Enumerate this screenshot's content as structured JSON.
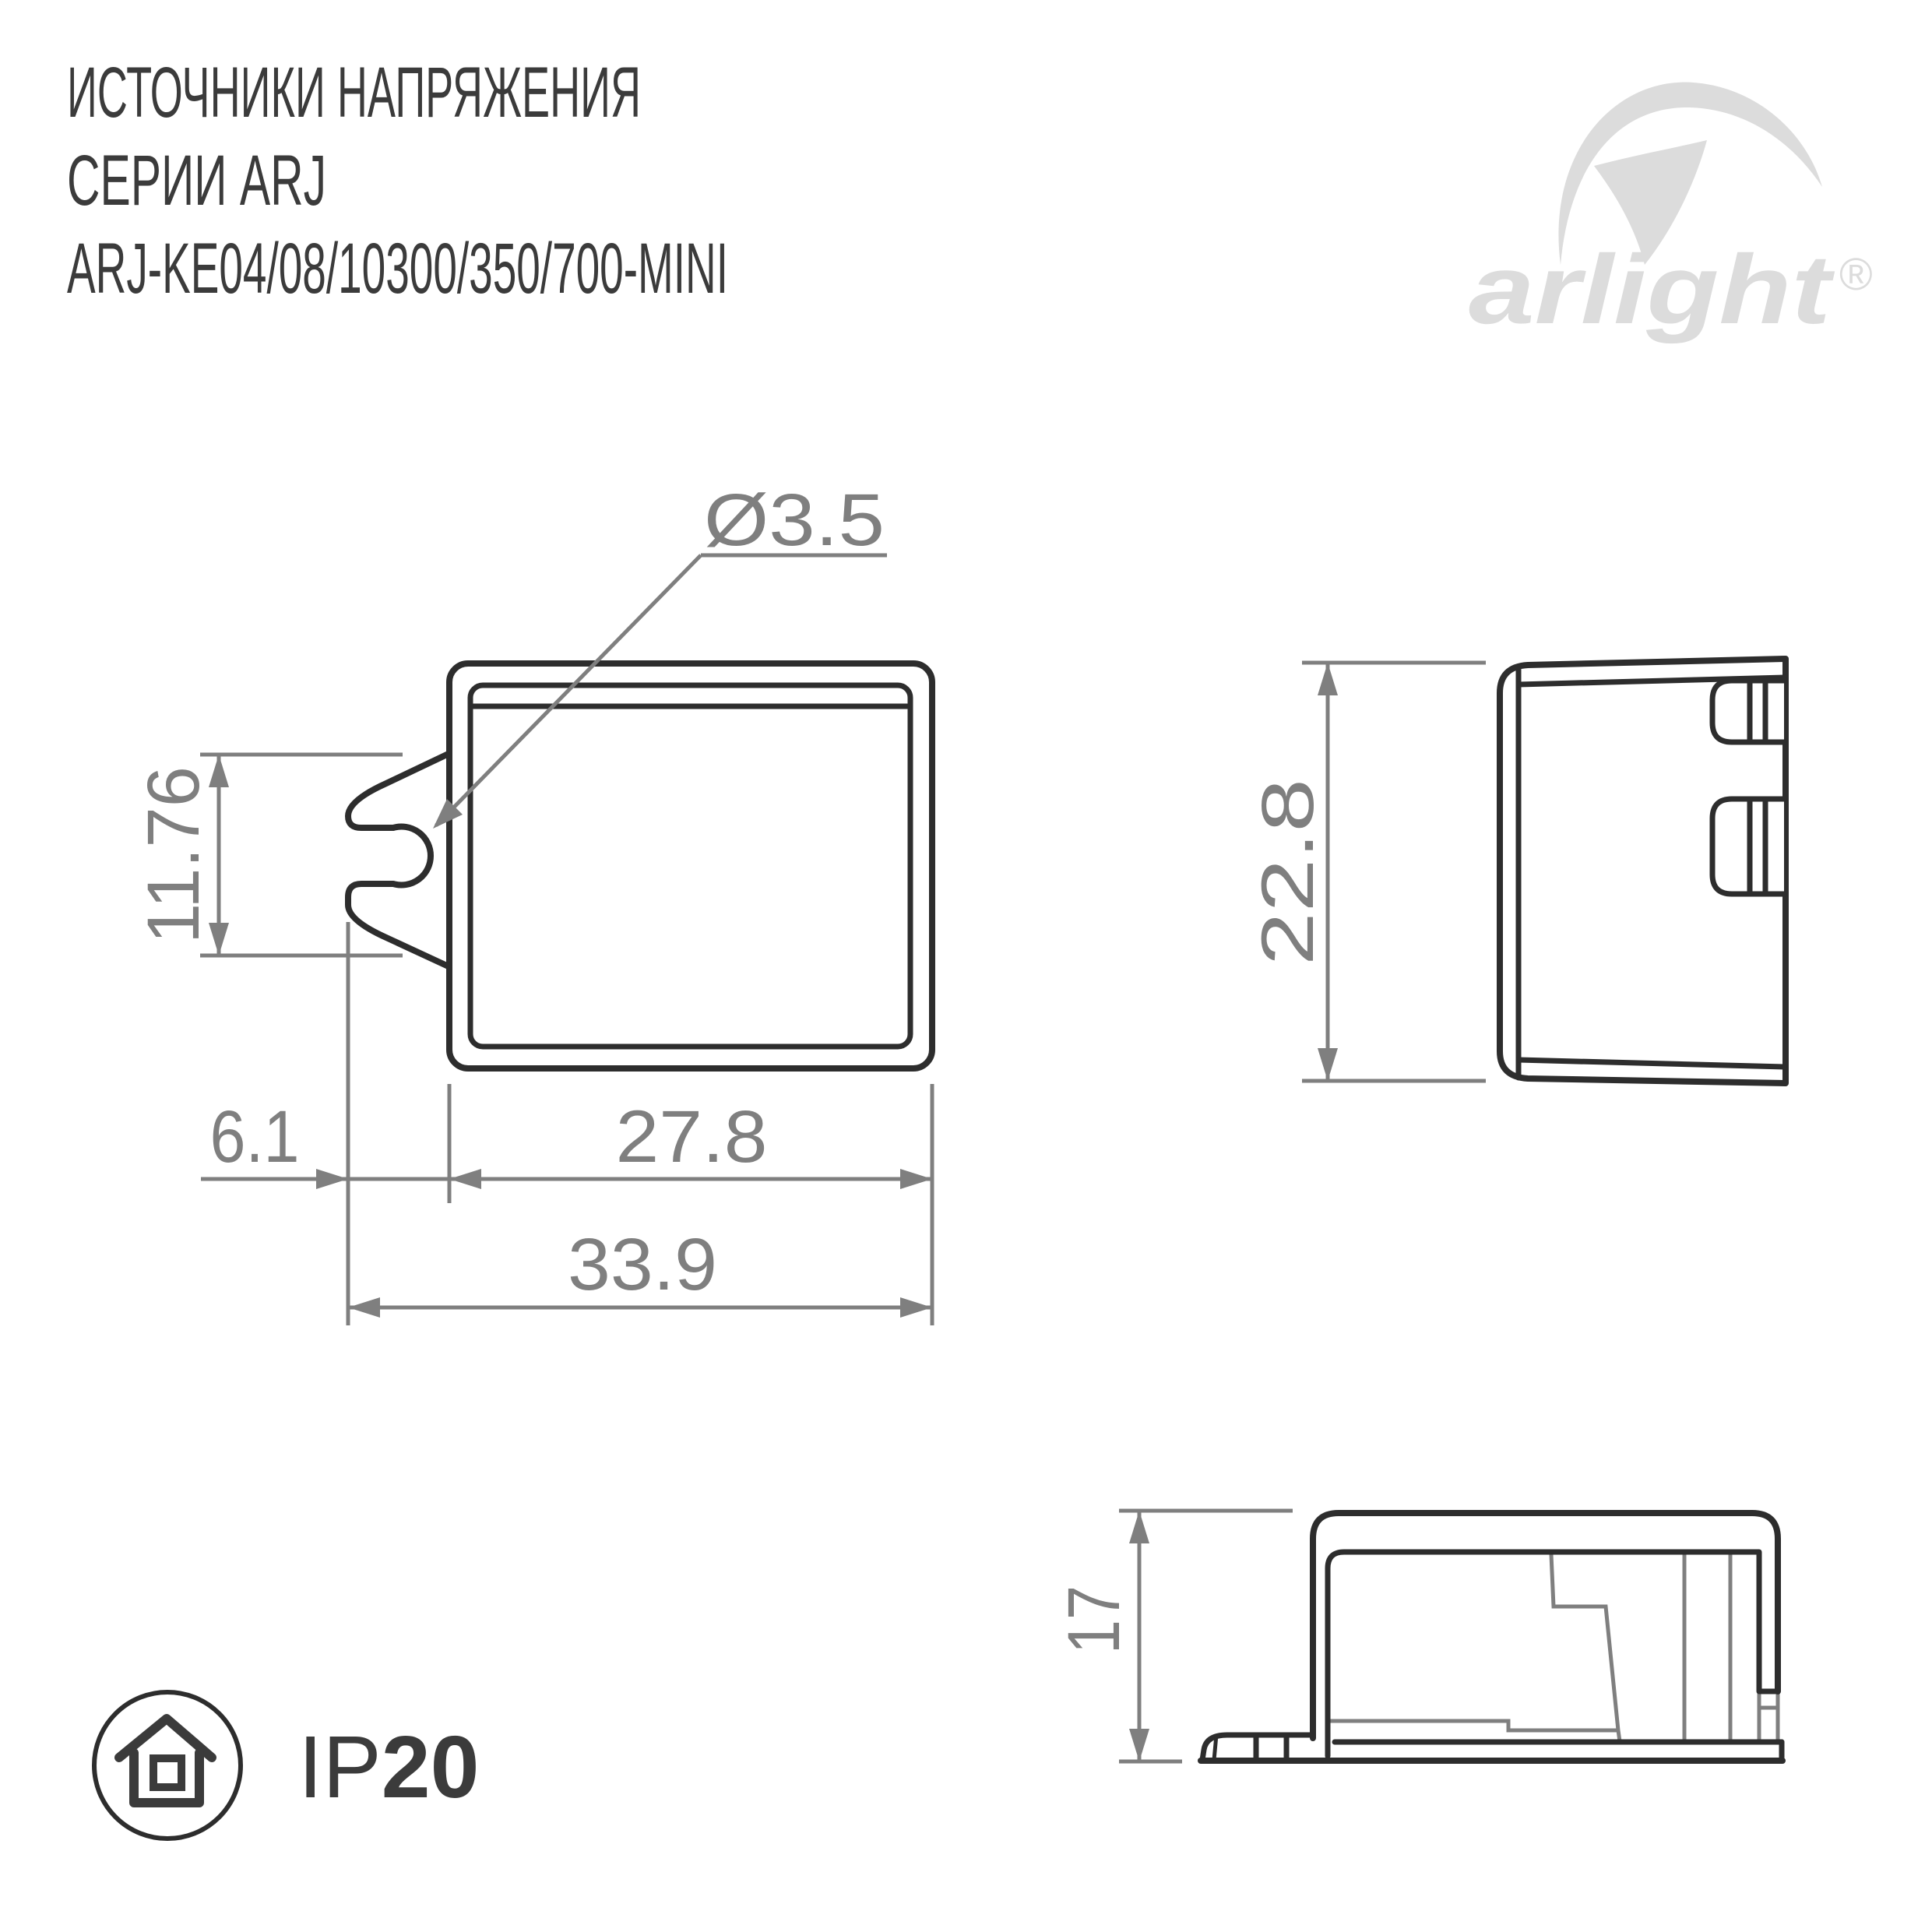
{
  "title": {
    "line1": "ИСТОЧНИКИ НАПРЯЖЕНИЯ",
    "line2": "СЕРИИ ARJ",
    "line3": "ARJ-KE04/08/10300/350/700-MINI"
  },
  "logo": {
    "brand": "arlight",
    "registered": "®"
  },
  "dimensions": {
    "hole_diameter": "Ø3.5",
    "clip_height": "11.76",
    "clip_offset": "6.1",
    "body_width": "27.8",
    "overall_width": "33.9",
    "body_height": "22.8",
    "profile_height": "17"
  },
  "protection": {
    "prefix": "IP",
    "value": "20"
  },
  "colors": {
    "drawing_line_dark": "#2d2d2d",
    "dimension_gray": "#7f7f7f",
    "text_dark": "#3b3b3b",
    "logo_gray": "#dcdcdc",
    "background": "#ffffff"
  }
}
